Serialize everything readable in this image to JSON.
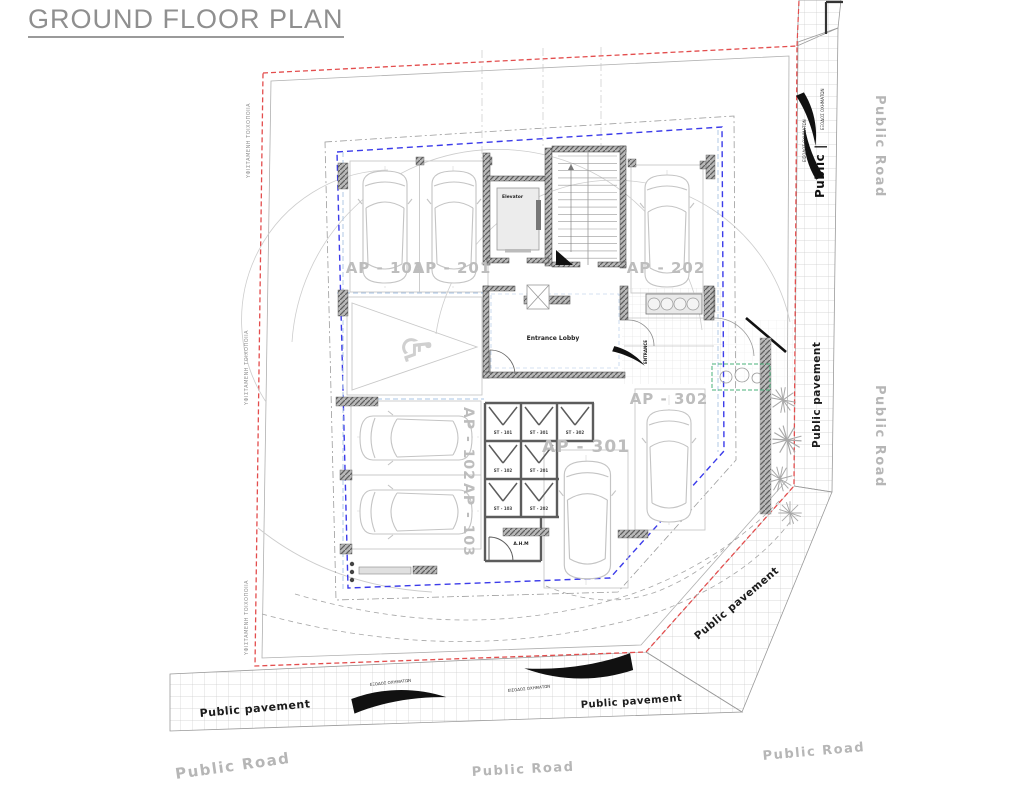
{
  "title": "GROUND FLOOR PLAN",
  "rooms": {
    "elevator": "Elevator",
    "entrance_lobby": "Entrance Lobby",
    "entrance": "ENTRANCE",
    "ahm": "A.H.M"
  },
  "apartments": {
    "ap101": "AP - 101",
    "ap201": "AP - 201",
    "ap202": "AP - 202",
    "ap102": "AP - 102",
    "ap103": "AP - 103",
    "ap301": "AP - 301",
    "ap302": "AP - 302"
  },
  "storage": {
    "st101": "ST - 101",
    "st301": "ST - 301",
    "st302": "ST - 302",
    "st102": "ST - 102",
    "st201": "ST - 201",
    "st103": "ST - 103",
    "st202": "ST - 202"
  },
  "site": {
    "public_road": "Public Road",
    "public_pavement": "Public pavement",
    "public_truncated": "Public |",
    "existing_masonry": "ΥΦΙΣΤΑΜΕΝΗ ΤΟΙΧΟΠΟΙΙΑ",
    "vehicle_entry": "ΕΙΣΟΔΟΣ ΟΧΗΜΑΤΩΝ",
    "vehicle_exit": "ΕΞΟΔΟΣ ΟΧΗΜΑΤΩΝ"
  },
  "icons": {
    "wheelchair": "♿"
  },
  "colors": {
    "boundary_red": "#e34d4d",
    "building_blue": "#3b3bea",
    "planter_green": "#49b27a",
    "road_text_gray": "#b6b6b6",
    "title_gray": "#8f8f8f"
  }
}
